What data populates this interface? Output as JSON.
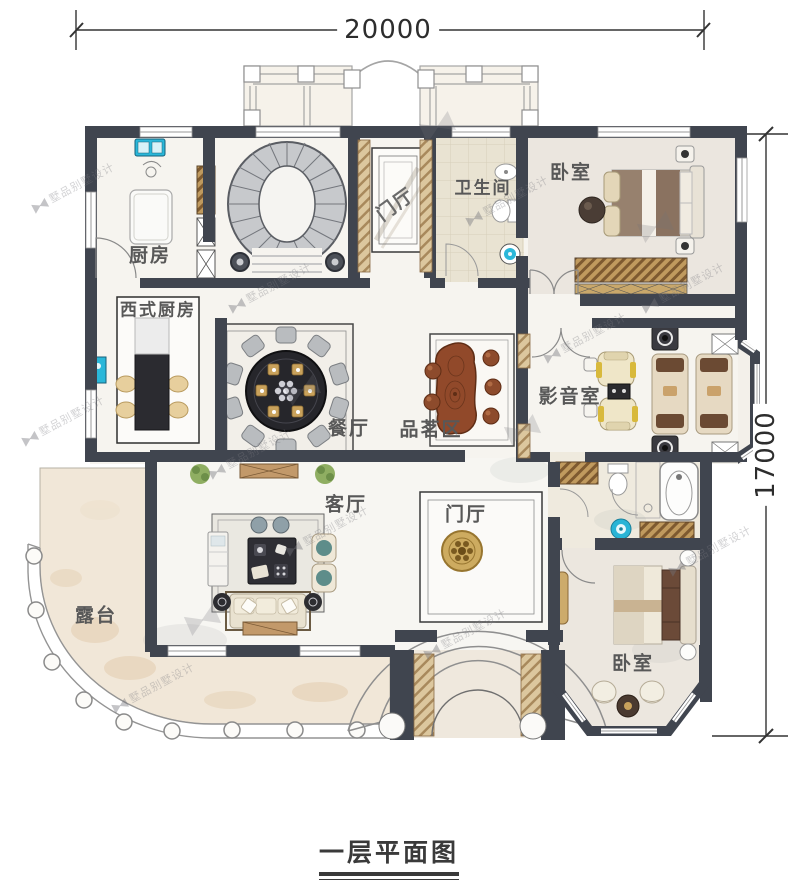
{
  "title": {
    "text": "一层平面图"
  },
  "dimensions": {
    "top": "20000",
    "right": "17000"
  },
  "watermark": {
    "text": "墅品别墅设计"
  },
  "rooms": {
    "kitchen": "厨房",
    "western_kitchen": "西式厨房",
    "foyer_top": "门厅",
    "bathroom": "卫生间",
    "bedroom_top": "卧室",
    "dining": "餐厅",
    "tea_area": "品茗区",
    "media_room": "影音室",
    "living_room": "客厅",
    "foyer_center": "门厅",
    "terrace": "露台",
    "bedroom_bottom": "卧室"
  },
  "colors": {
    "wall": "#40454f",
    "accent_cyan": "#2ab7d9",
    "wood": "#a4805a",
    "gold": "#c9a85c",
    "tea_wood": "#91492a"
  }
}
